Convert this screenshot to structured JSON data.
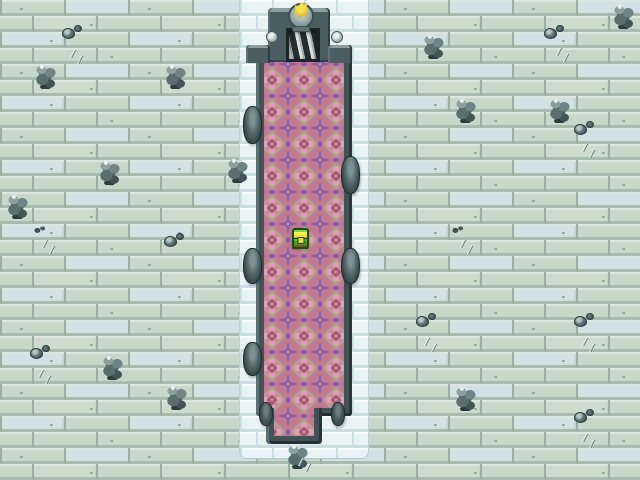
{
  "app": {
    "name": "rpg-dungeon-map",
    "description": "Top-down RPG dungeon hall: pale stone floor, pink carpeted chamber, stair entrance with golden statue, treasure chest"
  },
  "palette": {
    "floor_base": "#C7D7CA",
    "floor_highlight": "#DCE8DF",
    "floor_shadow": "#A8BBAF",
    "floor_grout": "#9AAEA2",
    "floor_blue_tile": "#D2E1E3",
    "moat_face": "#E9F2F4",
    "moat_highlight": "#F8FCFD",
    "moat_grout": "#C9DDE2",
    "wall_dark": "#415357",
    "wall_bevel": "#7E9295",
    "wall_edge": "#283437",
    "carpet_pink": "#C5798E",
    "carpet_pink_light": "#CE8C9D",
    "carpet_pink_dark": "#A55B72",
    "carpet_purple": "#8A5FAE",
    "carpet_accent": "#A2B193",
    "chest_green": "#4AA528",
    "chest_yellow": "#F7E23C",
    "chest_brown": "#8A5317",
    "chest_outline": "#1A4D0E",
    "statue_gold": "#E8C93A",
    "pedestal_grey": "#8EA1A0"
  },
  "scene": {
    "layout": {
      "moat": {
        "x": 240,
        "y": 0,
        "w": 128,
        "h": 458
      },
      "chamber": {
        "x": 256,
        "y": 54,
        "w": 96,
        "h": 362
      },
      "protrusion": {
        "x": 266,
        "y": 400,
        "w": 56,
        "h": 44
      },
      "carpet": {
        "x": 264,
        "y": 62,
        "w": 80,
        "h": 374
      },
      "portal": {
        "x": 268,
        "y": 8,
        "w": 62,
        "h": 54
      },
      "door": {
        "x": 286,
        "y": 28,
        "w": 34,
        "h": 34
      },
      "wing_left": {
        "x": 246,
        "y": 45,
        "w": 24,
        "h": 18
      },
      "wing_right": {
        "x": 328,
        "y": 45,
        "w": 24,
        "h": 18
      },
      "pommel_left": {
        "x": 266,
        "y": 31,
        "w": 12,
        "h": 12
      },
      "pommel_right": {
        "x": 331,
        "y": 31,
        "w": 12,
        "h": 12
      },
      "pedestal": {
        "x": 288,
        "y": 3,
        "w": 26,
        "h": 26
      },
      "pedestal_base": {
        "x": 292,
        "y": 26,
        "w": 18,
        "h": 6
      },
      "statue": {
        "x": 294,
        "y": 2,
        "w": 15,
        "h": 17
      },
      "chest": {
        "x": 292,
        "y": 228,
        "w": 17,
        "h": 21
      }
    },
    "knobs": [
      {
        "side": "left",
        "x": 243,
        "y": 106,
        "w": 19,
        "h": 38
      },
      {
        "side": "left",
        "x": 243,
        "y": 248,
        "w": 19,
        "h": 36
      },
      {
        "side": "left",
        "x": 243,
        "y": 342,
        "w": 19,
        "h": 34
      },
      {
        "side": "right",
        "x": 341,
        "y": 156,
        "w": 19,
        "h": 38
      },
      {
        "side": "right",
        "x": 341,
        "y": 248,
        "w": 19,
        "h": 36
      },
      {
        "side": "corner",
        "x": 259,
        "y": 402,
        "w": 14,
        "h": 24
      },
      {
        "side": "corner",
        "x": 331,
        "y": 402,
        "w": 14,
        "h": 24
      }
    ],
    "decorations": [
      {
        "type": "pile",
        "x": 34,
        "y": 62
      },
      {
        "type": "pile",
        "x": 164,
        "y": 62
      },
      {
        "type": "pile",
        "x": 98,
        "y": 158
      },
      {
        "type": "pile",
        "x": 6,
        "y": 192
      },
      {
        "type": "pile",
        "x": 226,
        "y": 156
      },
      {
        "type": "pile",
        "x": 101,
        "y": 353
      },
      {
        "type": "pile",
        "x": 165,
        "y": 383
      },
      {
        "type": "pile",
        "x": 422,
        "y": 32
      },
      {
        "type": "pile",
        "x": 454,
        "y": 96
      },
      {
        "type": "pile",
        "x": 548,
        "y": 96
      },
      {
        "type": "pile",
        "x": 612,
        "y": 2
      },
      {
        "type": "pile",
        "x": 454,
        "y": 384
      },
      {
        "type": "pile",
        "x": 286,
        "y": 442
      },
      {
        "type": "small",
        "x": 62,
        "y": 28
      },
      {
        "type": "small",
        "x": 544,
        "y": 28
      },
      {
        "type": "small",
        "x": 574,
        "y": 124
      },
      {
        "type": "small",
        "x": 164,
        "y": 236
      },
      {
        "type": "small",
        "x": 30,
        "y": 348
      },
      {
        "type": "small",
        "x": 416,
        "y": 316
      },
      {
        "type": "small",
        "x": 574,
        "y": 316
      },
      {
        "type": "small",
        "x": 574,
        "y": 412
      },
      {
        "type": "pebbles",
        "x": 34,
        "y": 226
      },
      {
        "type": "pebbles",
        "x": 452,
        "y": 226
      },
      {
        "type": "scratch",
        "x": 68,
        "y": 50
      },
      {
        "type": "scratch",
        "x": 554,
        "y": 48
      },
      {
        "type": "scratch",
        "x": 580,
        "y": 144
      },
      {
        "type": "scratch",
        "x": 40,
        "y": 240
      },
      {
        "type": "scratch",
        "x": 458,
        "y": 240
      },
      {
        "type": "scratch",
        "x": 36,
        "y": 370
      },
      {
        "type": "scratch",
        "x": 422,
        "y": 338
      },
      {
        "type": "scratch",
        "x": 580,
        "y": 338
      },
      {
        "type": "scratch",
        "x": 580,
        "y": 434
      },
      {
        "type": "scratch",
        "x": 296,
        "y": 458
      }
    ],
    "icons": {
      "chest": "treasure-chest-icon",
      "statue": "golden-statue-icon",
      "door": "stairway-icon",
      "pile": "rock-pile-icon",
      "small": "rock-icon",
      "pebbles": "pebbles-icon",
      "scratch": "floor-crack-icon",
      "knob": "wall-sconce-icon"
    }
  }
}
